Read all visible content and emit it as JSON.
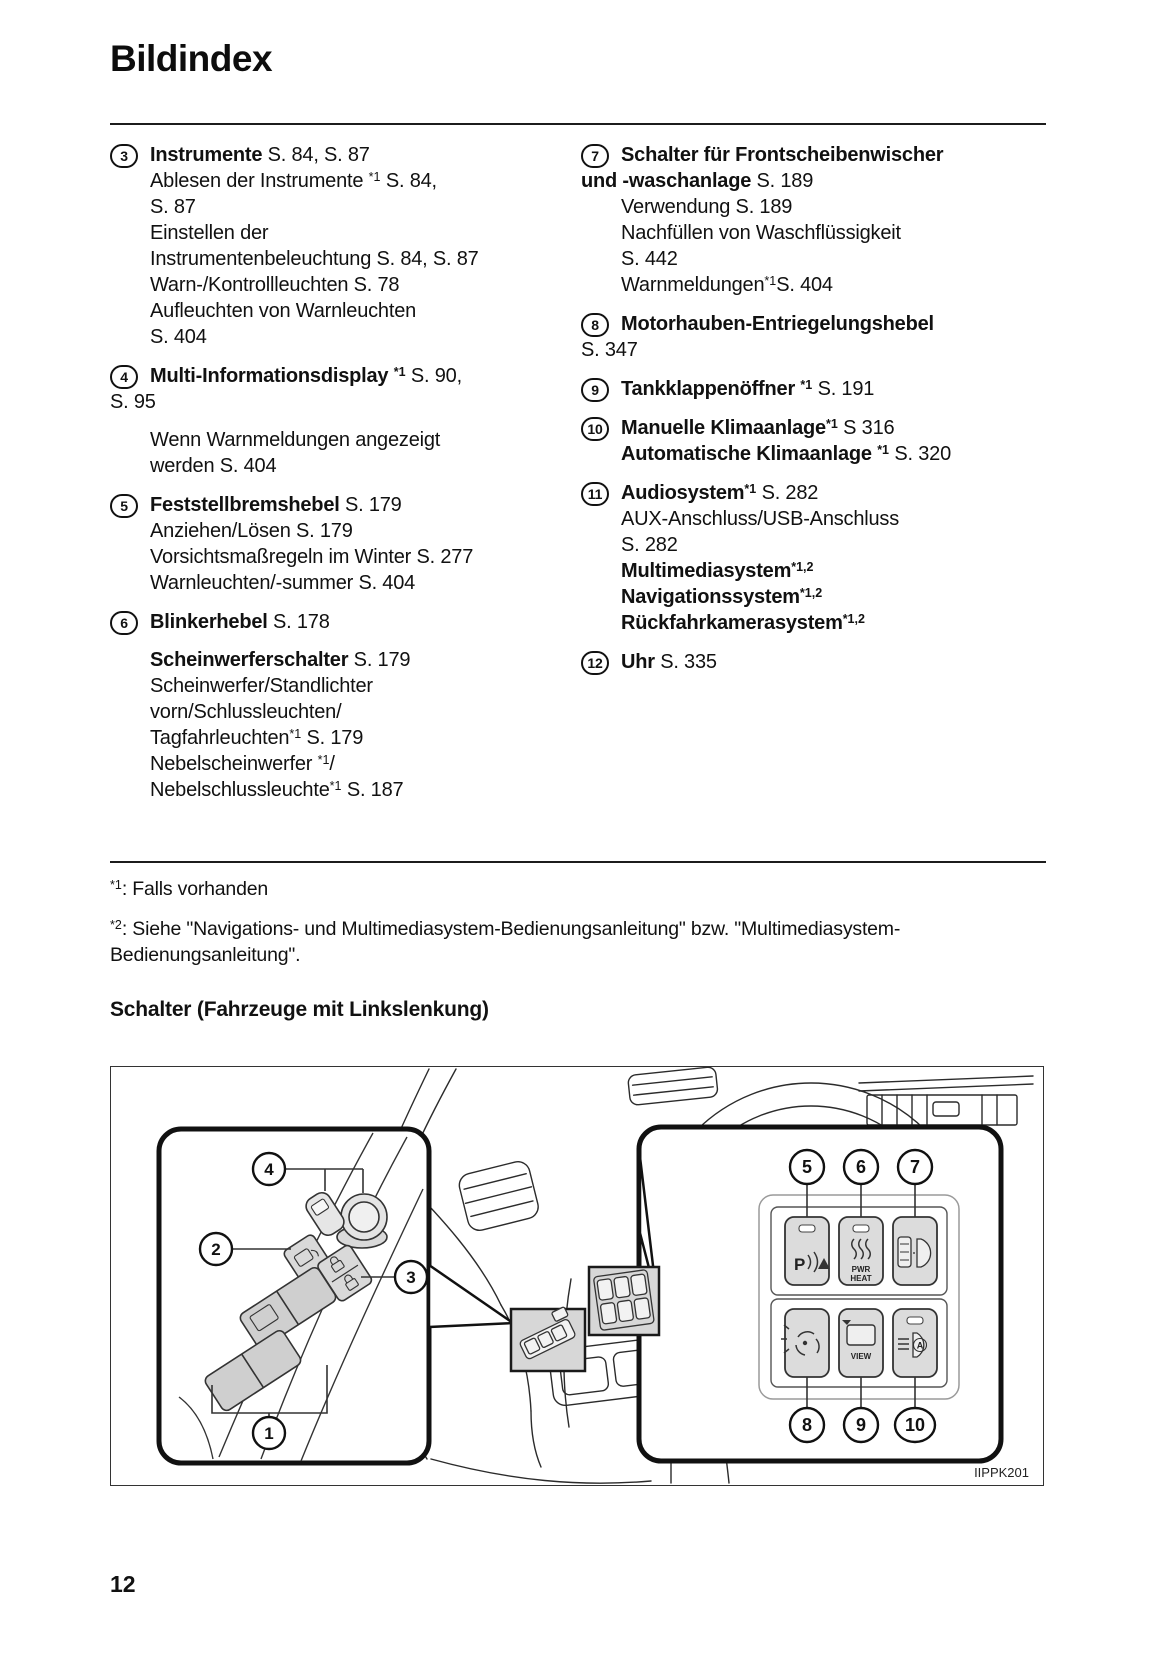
{
  "page": {
    "title": "Bildindex",
    "page_number": "12"
  },
  "index": {
    "columns": [
      {
        "items": [
          {
            "num": "3",
            "lines": [
              {
                "ind": 1,
                "segs": [
                  {
                    "t": "Instrumente",
                    "b": true
                  },
                  {
                    "t": " S. 84, S. 87"
                  }
                ]
              },
              {
                "ind": 1,
                "segs": [
                  {
                    "t": "Ablesen der Instrumente "
                  },
                  {
                    "t": "*1",
                    "sup": true
                  },
                  {
                    "t": " S. 84,"
                  }
                ]
              },
              {
                "ind": 1,
                "segs": [
                  {
                    "t": "S. 87"
                  }
                ]
              },
              {
                "ind": 1,
                "segs": [
                  {
                    "t": "Einstellen der"
                  }
                ]
              },
              {
                "ind": 1,
                "segs": [
                  {
                    "t": "Instrumentenbeleuchtung S. 84, S. 87"
                  }
                ]
              },
              {
                "ind": 1,
                "segs": [
                  {
                    "t": "Warn-/Kontrollleuchten S. 78"
                  }
                ]
              },
              {
                "ind": 1,
                "segs": [
                  {
                    "t": "Aufleuchten von Warnleuchten"
                  }
                ]
              },
              {
                "ind": 1,
                "segs": [
                  {
                    "t": "S. 404"
                  }
                ]
              }
            ]
          },
          {
            "num": "4",
            "lines": [
              {
                "ind": 1,
                "segs": [
                  {
                    "t": "Multi-Informationsdisplay ",
                    "b": true
                  },
                  {
                    "t": "*1",
                    "b": true,
                    "sup": true
                  },
                  {
                    "t": " S. 90,"
                  }
                ]
              },
              {
                "ind": 0,
                "segs": [
                  {
                    "t": "S. 95"
                  }
                ]
              },
              {
                "ind": 1,
                "gap": true,
                "segs": [
                  {
                    "t": "Wenn Warnmeldungen angezeigt"
                  }
                ]
              },
              {
                "ind": 1,
                "segs": [
                  {
                    "t": "werden S. 404"
                  }
                ]
              }
            ]
          },
          {
            "num": "5",
            "lines": [
              {
                "ind": 1,
                "segs": [
                  {
                    "t": "Feststellbremshebel",
                    "b": true
                  },
                  {
                    "t": " S. 179"
                  }
                ]
              },
              {
                "ind": 1,
                "segs": [
                  {
                    "t": "Anziehen/Lösen S. 179"
                  }
                ]
              },
              {
                "ind": 1,
                "segs": [
                  {
                    "t": "Vorsichtsmaßregeln im Winter S. 277"
                  }
                ]
              },
              {
                "ind": 1,
                "segs": [
                  {
                    "t": "Warnleuchten/-summer S. 404"
                  }
                ]
              }
            ]
          },
          {
            "num": "6",
            "lines": [
              {
                "ind": 1,
                "segs": [
                  {
                    "t": "Blinkerhebel",
                    "b": true
                  },
                  {
                    "t": " S. 178"
                  }
                ]
              },
              {
                "ind": 1,
                "gap": true,
                "segs": [
                  {
                    "t": "Scheinwerferschalter",
                    "b": true
                  },
                  {
                    "t": " S. 179"
                  }
                ]
              },
              {
                "ind": 1,
                "segs": [
                  {
                    "t": "Scheinwerfer/Standlichter"
                  }
                ]
              },
              {
                "ind": 1,
                "segs": [
                  {
                    "t": "vorn/Schlussleuchten/"
                  }
                ]
              },
              {
                "ind": 1,
                "segs": [
                  {
                    "t": "Tagfahrleuchten"
                  },
                  {
                    "t": "*1",
                    "sup": true
                  },
                  {
                    "t": " S. 179"
                  }
                ]
              },
              {
                "ind": 1,
                "segs": [
                  {
                    "t": "Nebelscheinwerfer "
                  },
                  {
                    "t": "*1",
                    "sup": true
                  },
                  {
                    "t": "/"
                  }
                ]
              },
              {
                "ind": 1,
                "segs": [
                  {
                    "t": "Nebelschlussleuchte"
                  },
                  {
                    "t": "*1",
                    "sup": true
                  },
                  {
                    "t": " S. 187"
                  }
                ]
              }
            ]
          }
        ]
      },
      {
        "items": [
          {
            "num": "7",
            "lines": [
              {
                "ind": 1,
                "segs": [
                  {
                    "t": "Schalter für Frontscheibenwischer",
                    "b": true
                  }
                ]
              },
              {
                "ind": 0,
                "segs": [
                  {
                    "t": "und -waschanlage",
                    "b": true
                  },
                  {
                    "t": " S. 189"
                  }
                ]
              },
              {
                "ind": 1,
                "segs": [
                  {
                    "t": "Verwendung S. 189"
                  }
                ]
              },
              {
                "ind": 1,
                "segs": [
                  {
                    "t": "Nachfüllen von Waschflüssigkeit"
                  }
                ]
              },
              {
                "ind": 1,
                "segs": [
                  {
                    "t": "S. 442"
                  }
                ]
              },
              {
                "ind": 1,
                "segs": [
                  {
                    "t": "Warnmeldungen"
                  },
                  {
                    "t": "*1",
                    "sup": true
                  },
                  {
                    "t": "S. 404"
                  }
                ]
              }
            ]
          },
          {
            "num": "8",
            "lines": [
              {
                "ind": 1,
                "segs": [
                  {
                    "t": "Motorhauben-Entriegelungshebel",
                    "b": true
                  }
                ]
              },
              {
                "ind": 0,
                "segs": [
                  {
                    "t": "S. 347"
                  }
                ]
              }
            ]
          },
          {
            "num": "9",
            "lines": [
              {
                "ind": 1,
                "segs": [
                  {
                    "t": "Tankklappenöffner ",
                    "b": true
                  },
                  {
                    "t": "*1",
                    "b": true,
                    "sup": true
                  },
                  {
                    "t": " S. 191"
                  }
                ]
              }
            ]
          },
          {
            "num": "10",
            "lines": [
              {
                "ind": 1,
                "segs": [
                  {
                    "t": "Manuelle Klimaanlage",
                    "b": true
                  },
                  {
                    "t": "*1",
                    "b": true,
                    "sup": true
                  },
                  {
                    "t": " S 316"
                  }
                ]
              },
              {
                "ind": 1,
                "segs": [
                  {
                    "t": "Automatische Klimaanlage ",
                    "b": true
                  },
                  {
                    "t": "*1",
                    "b": true,
                    "sup": true
                  },
                  {
                    "t": " S. 320"
                  }
                ]
              }
            ]
          },
          {
            "num": "11",
            "lines": [
              {
                "ind": 1,
                "segs": [
                  {
                    "t": "Audiosystem",
                    "b": true
                  },
                  {
                    "t": "*1",
                    "b": true,
                    "sup": true
                  },
                  {
                    "t": " S. 282"
                  }
                ]
              },
              {
                "ind": 1,
                "segs": [
                  {
                    "t": "AUX-Anschluss/USB-Anschluss"
                  }
                ]
              },
              {
                "ind": 1,
                "segs": [
                  {
                    "t": "S. 282"
                  }
                ]
              },
              {
                "ind": 1,
                "segs": [
                  {
                    "t": "Multimediasystem",
                    "b": true
                  },
                  {
                    "t": "*1,2",
                    "b": true,
                    "sup": true
                  }
                ]
              },
              {
                "ind": 1,
                "segs": [
                  {
                    "t": "Navigationssystem",
                    "b": true
                  },
                  {
                    "t": "*1,2",
                    "b": true,
                    "sup": true
                  }
                ]
              },
              {
                "ind": 1,
                "segs": [
                  {
                    "t": "Rückfahrkamerasystem",
                    "b": true
                  },
                  {
                    "t": "*1,2",
                    "b": true,
                    "sup": true
                  }
                ]
              }
            ]
          },
          {
            "num": "12",
            "lines": [
              {
                "ind": 1,
                "segs": [
                  {
                    "t": "Uhr",
                    "b": true
                  },
                  {
                    "t": " S. 335"
                  }
                ]
              }
            ]
          }
        ]
      }
    ]
  },
  "footnotes": {
    "fn1": {
      "marker": "*1",
      "text": ": Falls vorhanden"
    },
    "fn2": {
      "marker": "*2",
      "text": ": Siehe \"Navigations- und Multimediasystem-Bedienungsanleitung\" bzw. \"Multimediasystem-Bedienungsanleitung\"."
    }
  },
  "section": {
    "heading": "Schalter (Fahrzeuge mit Linkslenkung)"
  },
  "figure": {
    "code": "IIPPK201",
    "callouts": {
      "c1": "1",
      "c2": "2",
      "c3": "3",
      "c4": "4",
      "c5": "5",
      "c6": "6",
      "c7": "7",
      "c8": "8",
      "c9": "9",
      "c10": "10"
    },
    "switches": {
      "park_label": "P",
      "pwr_heat_line1": "PWR",
      "pwr_heat_line2": "HEAT",
      "view_label": "VIEW",
      "auto_light_label": "A"
    },
    "icons": [
      "parking-sensor-switch-icon",
      "pwr-heat-switch-icon",
      "headlight-washer-switch-icon",
      "wiper-deicer-switch-icon",
      "camera-view-switch-icon",
      "auto-headlight-switch-icon"
    ]
  }
}
